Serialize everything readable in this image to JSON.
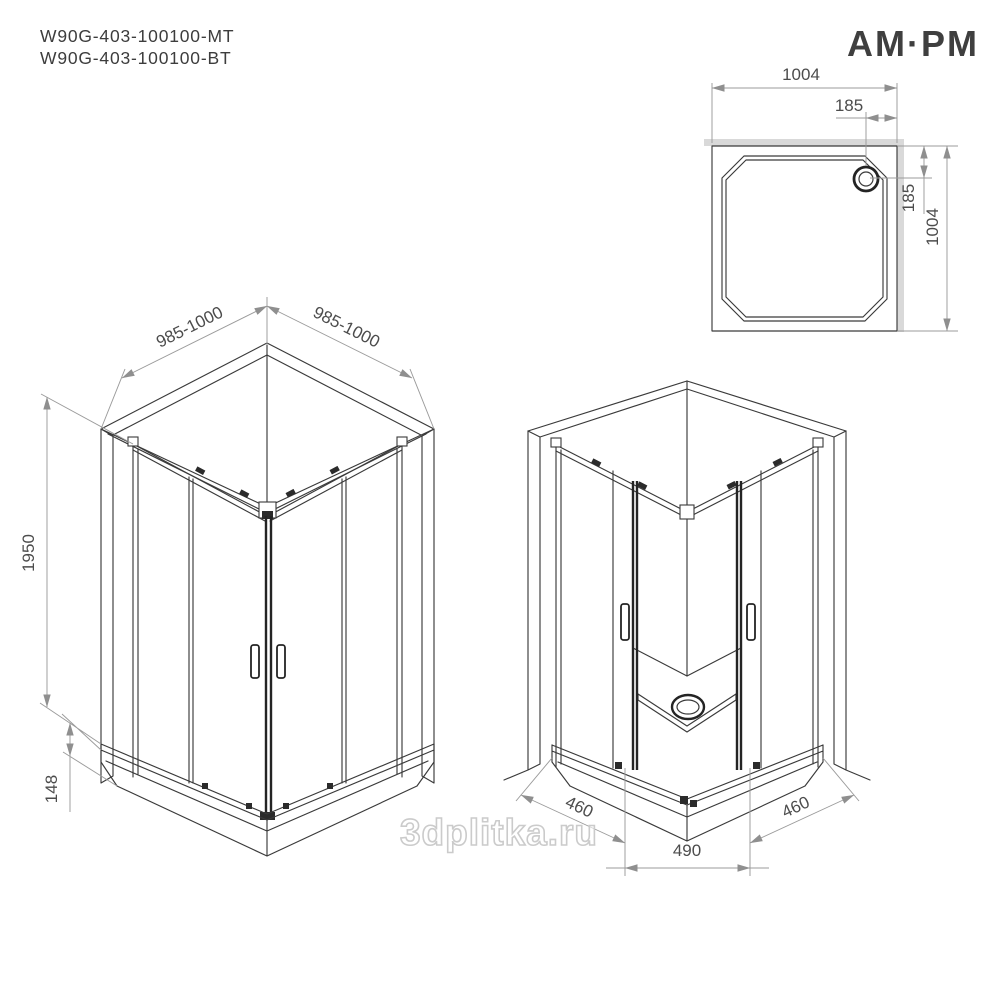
{
  "header": {
    "product_codes": [
      "W90G-403-100100-MT",
      "W90G-403-100100-BT"
    ],
    "brand": "AM·PM"
  },
  "watermark": "3dplitka.ru",
  "colors": {
    "line": "#3a3a3a",
    "bold_line": "#242424",
    "dimension": "#9b9b9b",
    "dim_text": "#4c4c4c",
    "wall_fill": "#d9d9d9"
  },
  "views": {
    "plan": {
      "width": "1004",
      "height": "1004",
      "drain_offset_top": "185",
      "drain_offset_side": "185"
    },
    "exterior_iso": {
      "width_left": "985-1000",
      "width_right": "985-1000",
      "height": "1950",
      "tray_height": "148"
    },
    "interior_iso": {
      "door_left": "460",
      "door_right": "460",
      "opening": "490"
    }
  }
}
